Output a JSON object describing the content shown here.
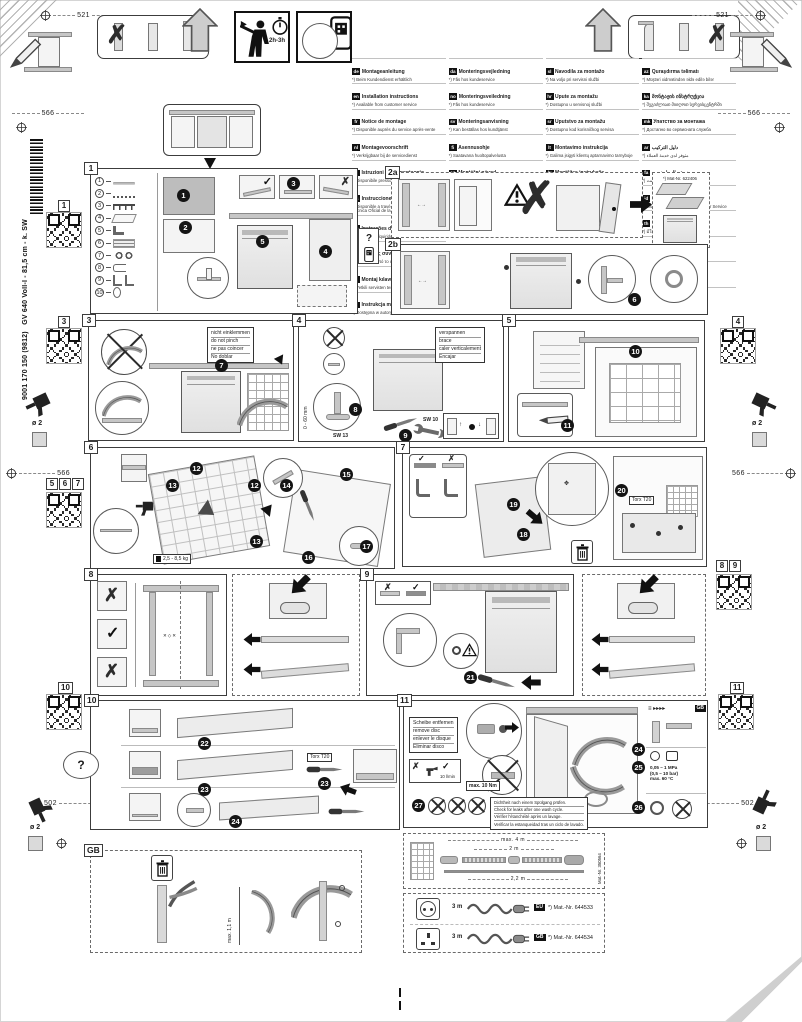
{
  "colors": {
    "ink": "#1c1c1c",
    "line": "#3c3c3c",
    "fill_mid": "#c6c6c6",
    "badge_bg": "#141414",
    "tag_bg": "#111111"
  },
  "header": {
    "dim_left": "521",
    "dim_right": "521",
    "time": "2h-3h"
  },
  "rails": {
    "left": {
      "dim_top": "566",
      "dim_mid": "566",
      "dim_bottom": "502",
      "drill_dia": "ø 2",
      "model": "GV 640 Voll-I - 81,5 cm - k. SW",
      "doc": "9001 170 150 (9812)",
      "qr1": "1",
      "qr3": "3",
      "qr567": [
        "5",
        "6",
        "7"
      ],
      "qr10": "10"
    },
    "right": {
      "dim_top": "566",
      "dim_mid": "566",
      "dim_bottom": "502",
      "drill_dia": "ø 2",
      "qr4": "4",
      "qr89": [
        "8",
        "9"
      ],
      "qr11": "11"
    }
  },
  "hint_scan": "?",
  "languages": {
    "col1": [
      {
        "code": "de",
        "title": "Montageanleitung",
        "note": "*) Beim Kundendienst erhältlich"
      },
      {
        "code": "en",
        "title": "Installation instructions",
        "note": "*) Available from customer service"
      },
      {
        "code": "fr",
        "title": "Notice de montage",
        "note": "*) Disponible auprès du service après-vente"
      },
      {
        "code": "nl",
        "title": "Montagevoorschrift",
        "note": "*) Verkrijgbaar bij de servicedienst"
      },
      {
        "code": "it",
        "title": "Istruzioni per il montaggio",
        "note": "*) Disponibile presso il servizio assistenza clienti"
      },
      {
        "code": "es",
        "title": "Instrucciones de montaje",
        "note": "*) Disponible a través del Servicio de Asistencia Técnica Oficial de la marca"
      },
      {
        "code": "pt",
        "title": "Instruções de montagem",
        "note": "*) Pode ser adquirido no nosso Serviço Técnico"
      },
      {
        "code": "el",
        "title": "Οδηγίες συναρμολόγησης",
        "note": "*) Διατίθεται από το σέρβις πελατών"
      },
      {
        "code": "tr",
        "title": "Montaj kılavuzu",
        "note": "*) Yetkili servisten temin edilebilir"
      },
      {
        "code": "pl",
        "title": "Instrukcja montażu",
        "note": "*) Dostępna w autoryzowanym serwisie"
      }
    ],
    "col2": [
      {
        "code": "da",
        "title": "Monteringsvejledning",
        "note": "*) Fås hos kundeservice"
      },
      {
        "code": "no",
        "title": "Monteringsveiledning",
        "note": "*) Fås hos kundeservice"
      },
      {
        "code": "sv",
        "title": "Monteringsanvisning",
        "note": "*) Kan beställas hos kundtjänst"
      },
      {
        "code": "fi",
        "title": "Asennusohje",
        "note": "*) Saatavana huoltopalvelusta"
      },
      {
        "code": "cs",
        "title": "Montážní návod",
        "note": "*) Obdržíte u zákaznického servisu"
      },
      {
        "code": "sk",
        "title": "Montážny návod",
        "note": "*) Dostupné v zákazníckom servise"
      },
      {
        "code": "hu",
        "title": "Szerelési útmutató",
        "note": "*) Az ügyfélszolgálatnál szerezhető be"
      },
      {
        "code": "ro",
        "title": "Instrucţiuni de montaj",
        "note": "*) Se poate obţine de la unităţile service"
      },
      {
        "code": "uk",
        "title": "Інструкція з монтажу",
        "note": "*) Можна отримати в сервісному центрі"
      },
      {
        "code": "ru",
        "title": "Инструкция по монтажу",
        "note": "*) Можно получить в сервисной службе"
      }
    ],
    "col3": [
      {
        "code": "sl",
        "title": "Navodila za montažo",
        "note": "*) Na voljo pri servisni službi"
      },
      {
        "code": "hr",
        "title": "Upute za montažu",
        "note": "*) Dostupno u servisnoj službi"
      },
      {
        "code": "sr",
        "title": "Uputstvo za montažu",
        "note": "*) Dostupno kod korisničkog servisa"
      },
      {
        "code": "lt",
        "title": "Montavimo instrukcija",
        "note": "*) Galima įsigyti klientų aptarnavimo tarnyboje"
      },
      {
        "code": "lv",
        "title": "Montāžas instrukcija",
        "note": "*) Pieejama klientu servisā"
      },
      {
        "code": "et",
        "title": "Paigaldusjuhend",
        "note": "*) Saadaval klienditeenindusest"
      },
      {
        "code": "bg",
        "title": "Инструкция за монтаж",
        "note": "*) Получава се от сервизната служба"
      },
      {
        "code": "kk",
        "title": "Монтаждау нұсқаулығы",
        "note": "*) Қызмет көрсету орталығынан алуға болады"
      }
    ],
    "col4": [
      {
        "code": "az",
        "title": "Quraşdırma təlimatı",
        "note": "*) Müştəri xidmətindən əldə edilə bilər"
      },
      {
        "code": "ka",
        "title": "მონტაჟის ინსტრუქცია",
        "note": "*) შეგიძლიათ მიიღოთ სერვისცენტრში"
      },
      {
        "code": "mk",
        "title": "Упатство за монтажа",
        "note": "*) Достапно во сервисната служба"
      },
      {
        "code": "ar",
        "title": "دليل التركيب",
        "note": "*) متوفر لدى خدمة العملاء"
      },
      {
        "code": "fa",
        "title": "دستورالعمل نصب",
        "note": "*) از خدمات مشتریان قابل تهیه است"
      },
      {
        "code": "id",
        "title": "Instruksi pemasangan",
        "note": "*) bisa didapatkan melalui Customer Service"
      },
      {
        "code": "th",
        "title": "คำแนะนำการติดตั้ง",
        "note": "*) มีให้ที่ศูนย์บริการลูกค้า"
      },
      {
        "code": "ko",
        "title": "설치 설명서",
        "note": "*) 고객센터에서 구입 가능"
      },
      {
        "code": "zh",
        "title": "安装说明",
        "note": "*) 可向售后服务部门索取"
      },
      {
        "code": "zh",
        "title": "安裝說明書",
        "note": "*) 可向客戶服務中心索取"
      }
    ]
  },
  "panels": {
    "p1": {
      "tag": "1",
      "badges": [
        "1",
        "2",
        "3",
        "4",
        "5"
      ],
      "parts": [
        {
          "num": "1",
          "icon": "strip"
        },
        {
          "num": "2",
          "icon": "cord"
        },
        {
          "num": "3",
          "icon": "screws"
        },
        {
          "num": "4",
          "icon": "template"
        },
        {
          "num": "5",
          "icon": "angles"
        },
        {
          "num": "6",
          "icon": "plates"
        },
        {
          "num": "7",
          "icon": "rings"
        },
        {
          "num": "8",
          "icon": "clip"
        },
        {
          "num": "9",
          "icon": "brackets"
        },
        {
          "num": "10",
          "icon": "oval"
        }
      ]
    },
    "p2a": {
      "tag": "2a",
      "mat_note": "*) Mat-Nr. 622406"
    },
    "p2b": {
      "tag": "2b",
      "badge": "6"
    },
    "p3": {
      "tag": "3",
      "badge": "7",
      "note": [
        "nicht einklemmen",
        "do not pinch",
        "ne pas coincer",
        "No doblar"
      ]
    },
    "p4": {
      "tag": "4",
      "badges": [
        "8",
        "9"
      ],
      "note": [
        "verspannen",
        "brace",
        "caler verticalement",
        "Encajar"
      ],
      "sw13": "SW 13",
      "sw10": "SW 10",
      "range": "0 - 60 mm"
    },
    "p5": {
      "tag": "5",
      "badges": [
        "10",
        "11"
      ]
    },
    "p6": {
      "tag": "6",
      "badges": [
        "12",
        "13",
        "12",
        "13",
        "14",
        "15",
        "16",
        "17"
      ],
      "weight": "2,5 - 8,5 kg"
    },
    "p7": {
      "tag": "7",
      "badges": [
        "18",
        "19",
        "20"
      ],
      "torx": "Torx T20"
    },
    "p8": {
      "tag": "8"
    },
    "p9": {
      "tag": "9",
      "badge": "21"
    },
    "p10": {
      "tag": "10",
      "badges": [
        "22",
        "23",
        "23",
        "24"
      ],
      "torx": "Torx T20"
    },
    "p11": {
      "tag": "11",
      "badges": [
        "24",
        "25",
        "26",
        "27"
      ],
      "note": [
        "Scheibe entfernen",
        "remove disc",
        "enlever le disque",
        "Eliminar disco"
      ],
      "torque": "max. 10 Nm",
      "flow": "10 l/min",
      "gb_tag": "GB",
      "pressure": [
        "0,05 – 1 MPa",
        "(0,5 – 10 bar)",
        "max. 60 °C"
      ],
      "leak_note": [
        "Dichtheit nach einem Spülgang prüfen.",
        "Check for leaks after one wash cycle.",
        "Vérifier l'étanchéité après un lavage.",
        "Verificar la estanqueidad tras un ciclo de lavado."
      ]
    },
    "pgb": {
      "tag": "GB",
      "dim": "max. 1,1 m"
    },
    "hose": {
      "dim_total": "max. 4 m",
      "dim_upper": "2 m",
      "dim_lower": "2,2 m",
      "mat": "Mat.-Nr. 350564"
    },
    "plugs": [
      {
        "len": "3 m",
        "tag": "EU",
        "mat": "*) Mat.-Nr. 644533"
      },
      {
        "len": "3 m",
        "tag": "GB",
        "mat": "*) Mat.-Nr. 644534"
      }
    ]
  }
}
